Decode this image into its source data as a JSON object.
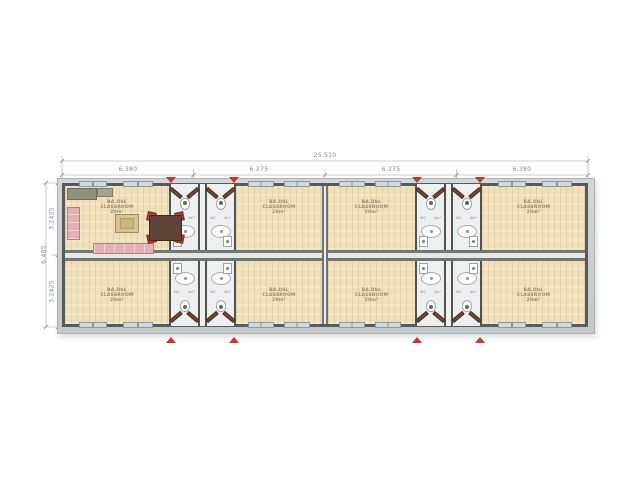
{
  "drawing": {
    "dimensions": {
      "overall_width": "25.510",
      "top_segments": [
        "6.380",
        "6.275",
        "6.275",
        "6.380"
      ],
      "overall_height": "6.485",
      "left_segments": [
        "3.2425",
        "3.2425"
      ]
    },
    "rooms": {
      "label_line1": "BA.DbL",
      "label_line2": "CLASSROOM",
      "label_line3": "20m²"
    },
    "core": {
      "wc_label": "WC",
      "area_label": "4m²"
    },
    "colors": {
      "floor_wood": "#efe0ba",
      "wall": "#565b5f",
      "eave": "#c8cccf",
      "corridor_floor": "#edeff0",
      "window": "#cfdadd",
      "entrance_marker_red": "#cf3227",
      "door_leaf_brown": "#714634",
      "sofa_pink": "#e3b0b4",
      "chair_red": "#ae3e34",
      "dimension_text": "#82888c"
    }
  }
}
